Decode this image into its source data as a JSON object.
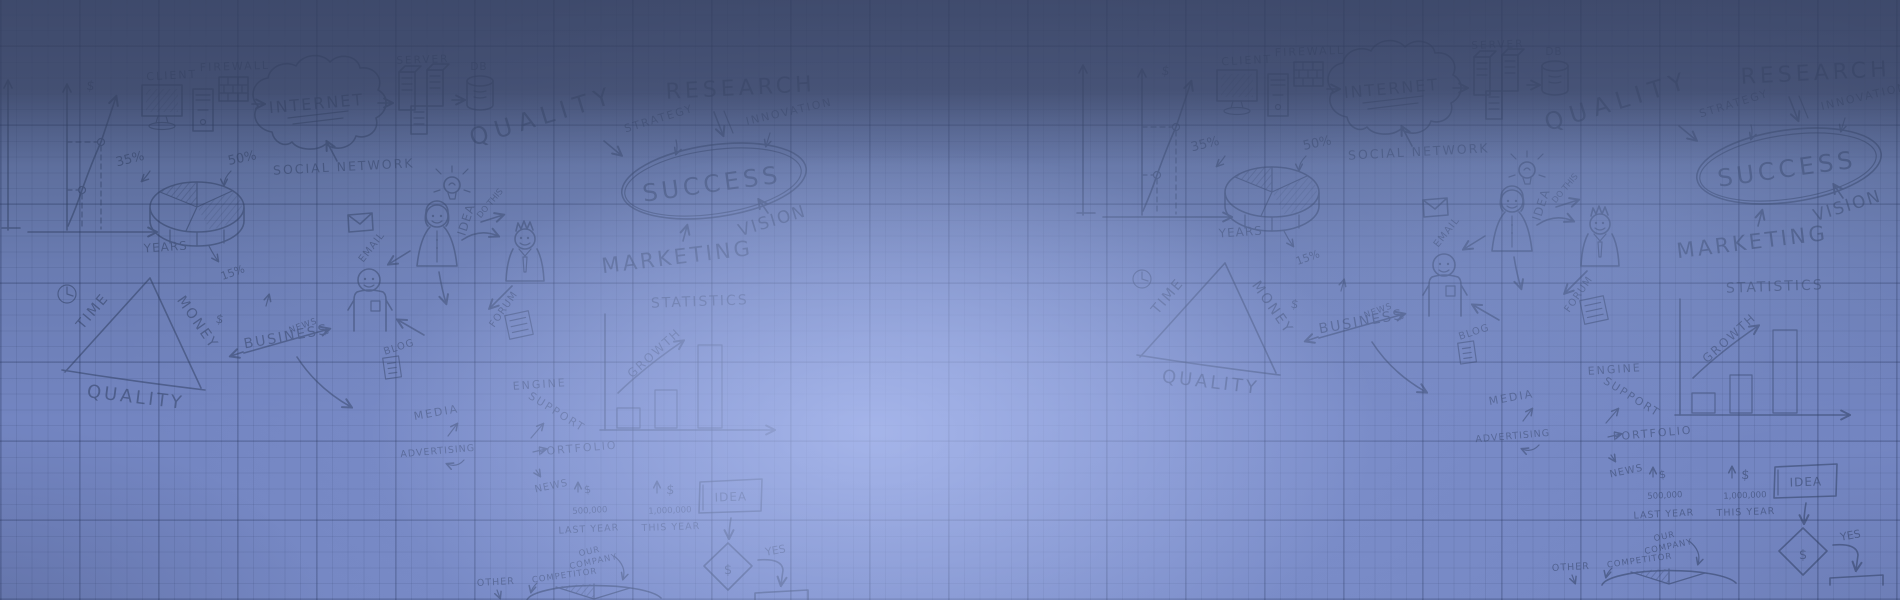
{
  "palette": {
    "bg_top": "#4c5a81",
    "bg_middle": "#6a7cb2",
    "bg_bottom": "#7688c4",
    "top_band": "#38425f",
    "highlight": "#bfccfc",
    "grid_line": "#1b284c",
    "sketch_stroke": "#2f3e60"
  },
  "labels": {
    "client": "CLIENT",
    "firewall": "FIREWALL",
    "internet": "INTERNET",
    "server": "SERVER",
    "db": "DB",
    "quality": "QUALITY",
    "strategy": "STRATEGY",
    "research": "RESEARCH",
    "innovation": "INNOVATION",
    "success": "SUCCESS",
    "vision": "VISION",
    "marketing": "MARKETING",
    "social_network": "SOCIAL NETWORK",
    "email": "EMAIL",
    "do_this": "DO THIS",
    "idea": "IDEA",
    "pct_35": "35%",
    "pct_50": "50%",
    "pct_15": "15%",
    "years": "YEARS",
    "dollar": "$",
    "time": "TIME",
    "money": "MONEY",
    "business": "BUSINESS",
    "statistics": "STATISTICS",
    "growth": "GROWTH",
    "engine": "ENGINE",
    "support": "SUPPORT",
    "portfolio": "PORTFOLIO",
    "news": "NEWS",
    "media": "MEDIA",
    "advertising": "ADVERTISING",
    "blog": "BLOG",
    "forum": "FORUM",
    "yes": "YES",
    "last_year": "LAST YEAR",
    "this_year": "THIS YEAR",
    "amount_last": "500,000",
    "amount_this": "1,000,000",
    "our": "OUR",
    "company": "COMPANY",
    "competitor": "COMPETITOR",
    "other": "OTHER"
  }
}
